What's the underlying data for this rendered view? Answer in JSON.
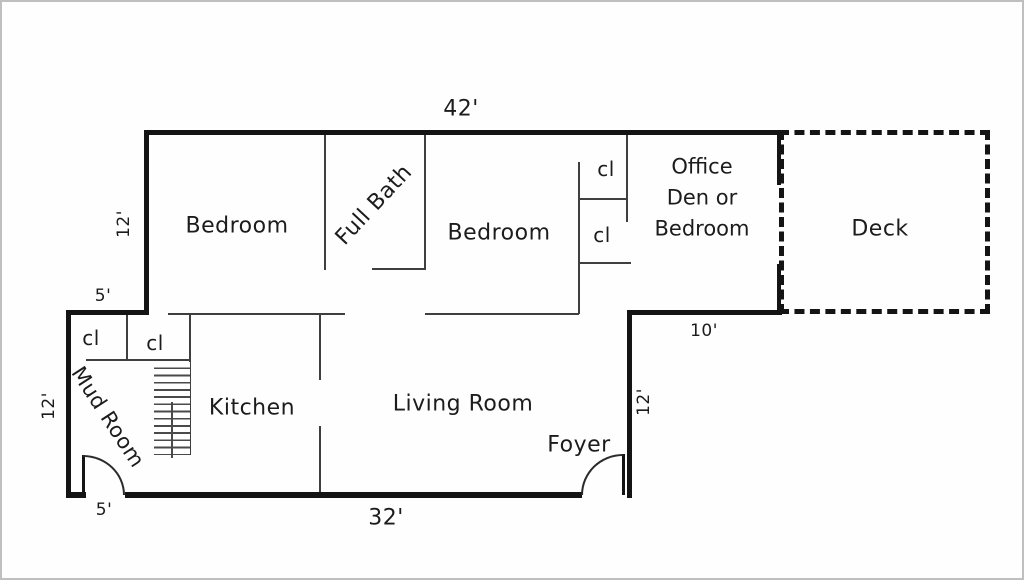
{
  "floorplan": {
    "rooms": {
      "bedroom1": "Bedroom",
      "full_bath": "Full Bath",
      "bedroom2": "Bedroom",
      "office": {
        "line1": "Office",
        "line2": "Den or",
        "line3": "Bedroom"
      },
      "deck": "Deck",
      "mud_room": "Mud Room",
      "kitchen": "Kitchen",
      "living_room": "Living Room",
      "foyer": "Foyer"
    },
    "closets": {
      "upper_1": "cl",
      "upper_2": "cl",
      "lower_1": "cl",
      "lower_2": "cl"
    },
    "dimensions": {
      "top_width": "42'",
      "upper_left_height": "12'",
      "step_width": "5'",
      "lower_left_height": "12'",
      "mud_door_width": "5'",
      "bottom_width": "32'",
      "hall_width": "10'",
      "foyer_right_height": "12'"
    },
    "colors": {
      "wall": "#141414",
      "thin_wall": "#3f3f3f",
      "text": "#1c1c1c",
      "background": "#fefefe",
      "frame": "#bfbfbf"
    }
  }
}
